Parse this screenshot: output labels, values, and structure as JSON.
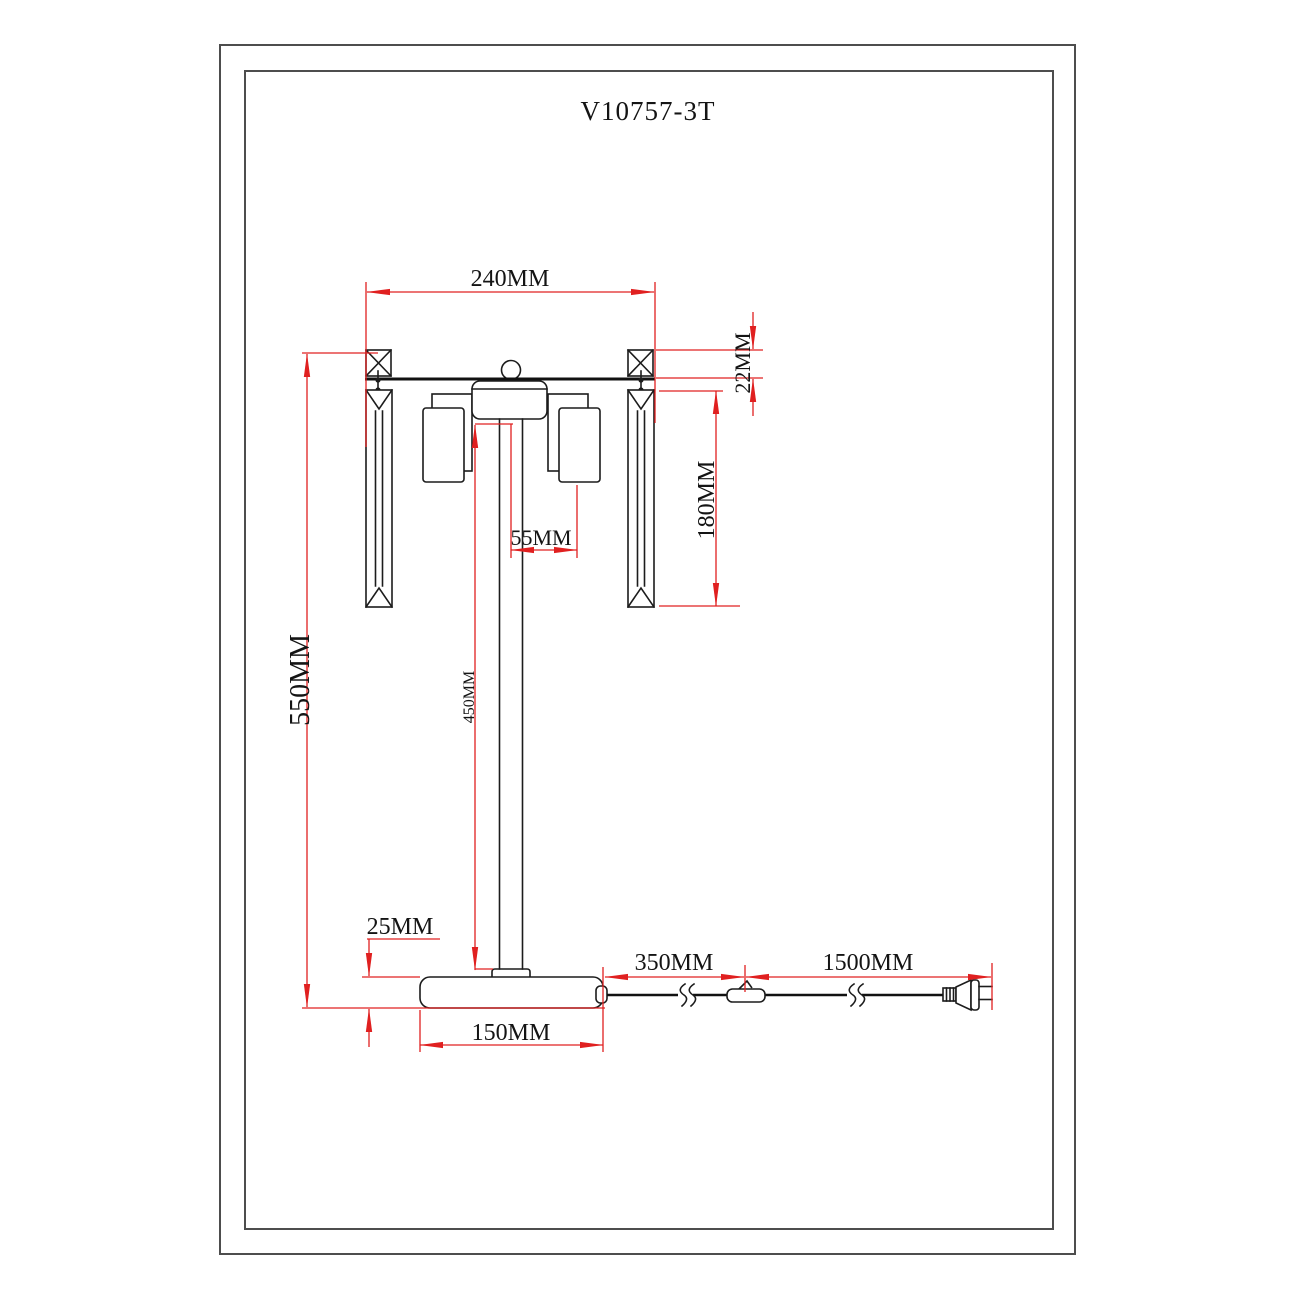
{
  "title": "V10757-3T",
  "colors": {
    "dimension_red": "#e02020",
    "drawing_black": "#1c1c1c",
    "frame_gray": "#4d4d4d",
    "background": "#ffffff"
  },
  "dimensions": {
    "top_width": "240MM",
    "head_height": "22MM",
    "crystal_length": "180MM",
    "shade_offset": "55MM",
    "total_height": "550MM",
    "pole_height": "450MM",
    "base_height": "25MM",
    "base_width": "150MM",
    "cord_to_switch": "350MM",
    "switch_to_plug": "1500MM"
  }
}
